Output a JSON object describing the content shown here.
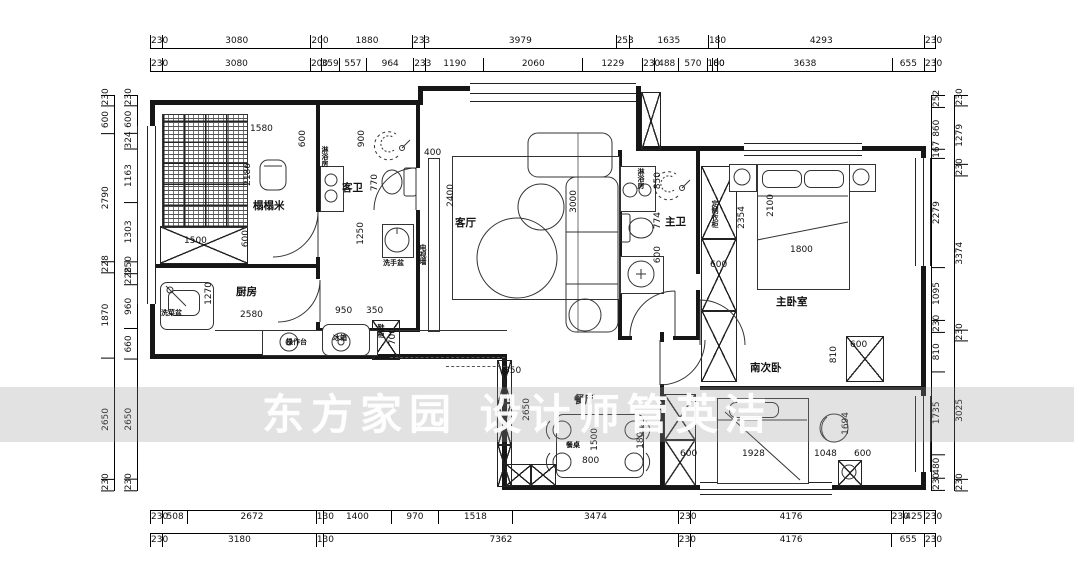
{
  "watermark": {
    "text": "东方家园 设计师管英洁"
  },
  "dim_rows": {
    "top_outer": [
      "230",
      "3080",
      "200",
      "1880",
      "233",
      "3979",
      "253",
      "1635",
      "180",
      "4293",
      "230"
    ],
    "top_inner": [
      "230",
      "3080",
      "200",
      "359",
      "557",
      "964",
      "233",
      "1190",
      "2060",
      "1229",
      "230",
      "488",
      "570",
      "100",
      "80",
      "3638",
      "655",
      "230"
    ],
    "bottom_inner": [
      "230",
      "508",
      "2672",
      "130",
      "1400",
      "970",
      "1518",
      "3474",
      "230",
      "4176",
      "230",
      "425",
      "230"
    ],
    "bottom_outer": [
      "230",
      "3180",
      "130",
      "7362",
      "230",
      "4176",
      "655",
      "230"
    ],
    "left_outer": [
      "230",
      "600",
      "2790",
      "228",
      "1870",
      "2650",
      "230"
    ],
    "left_inner": [
      "230",
      "600",
      "324",
      "1163",
      "1303",
      "250",
      "228",
      "960",
      "660",
      "2650",
      "230"
    ],
    "right_inner": [
      "252",
      "860",
      "167",
      "2279",
      "1095",
      "230",
      "810",
      "1735",
      "480",
      "230"
    ],
    "right_outer": [
      "230",
      "1279",
      "230",
      "3374",
      "230",
      "3025",
      "230"
    ]
  },
  "rooms": {
    "tatami": {
      "name": "榻榻米"
    },
    "kitchen": {
      "name": "厨房"
    },
    "guest_bath": {
      "name": "客卫"
    },
    "living": {
      "name": "客厅"
    },
    "master_bath": {
      "name": "主卫"
    },
    "master_bedroom": {
      "name": "主卧室"
    },
    "south_bedroom": {
      "name": "南次卧"
    },
    "dining": {
      "name": "餐厅"
    }
  },
  "fixtures": {
    "shower_room_guest": "淋浴房",
    "shower_room_master": "淋浴房",
    "hand_basin": "洗手盆",
    "veg_sink": "洗菜盆",
    "counter": "操作台",
    "fridge": "冰箱",
    "shoe_cabinet": "鞋柜",
    "tv_wall": "电视墙",
    "wardrobe": "定制衣柜",
    "dining_table": "餐桌"
  },
  "interior_dims": {
    "tatami_top": "1580",
    "tatami_top_side": "600",
    "tatami_right": "2186",
    "tatami_bottom_side": "600",
    "tatami_closet": "1500",
    "gb_shower": "900",
    "gb_toilet": "770",
    "gb_basin": "1250",
    "lv_nook": "400",
    "lv_tv": "2400",
    "lv_sofa": "3000",
    "kt_depth": "1270",
    "kt_run": "2580",
    "kt_fridge": "950",
    "kt_shoe": "350",
    "kt_shoe_h": "700",
    "mb_washer": "850",
    "mb_toilet": "774",
    "mb_basin": "600",
    "mbr_wardrobe_h": "2354",
    "mbr_wardrobe_w": "600",
    "mbr_bed_l": "2100",
    "mbr_bed_w": "1800",
    "sb_cab_offset": "810",
    "sb_cab": "600",
    "sb_bed": "1694",
    "sb_wardrobe": "600",
    "sb_bed_w": "1928",
    "sb_floor": "1048",
    "sb_right": "600",
    "dn_win": "350",
    "dn_depth": "2650",
    "dn_table_l": "1500",
    "dn_table_w": "800",
    "dn_pass": "1800"
  }
}
